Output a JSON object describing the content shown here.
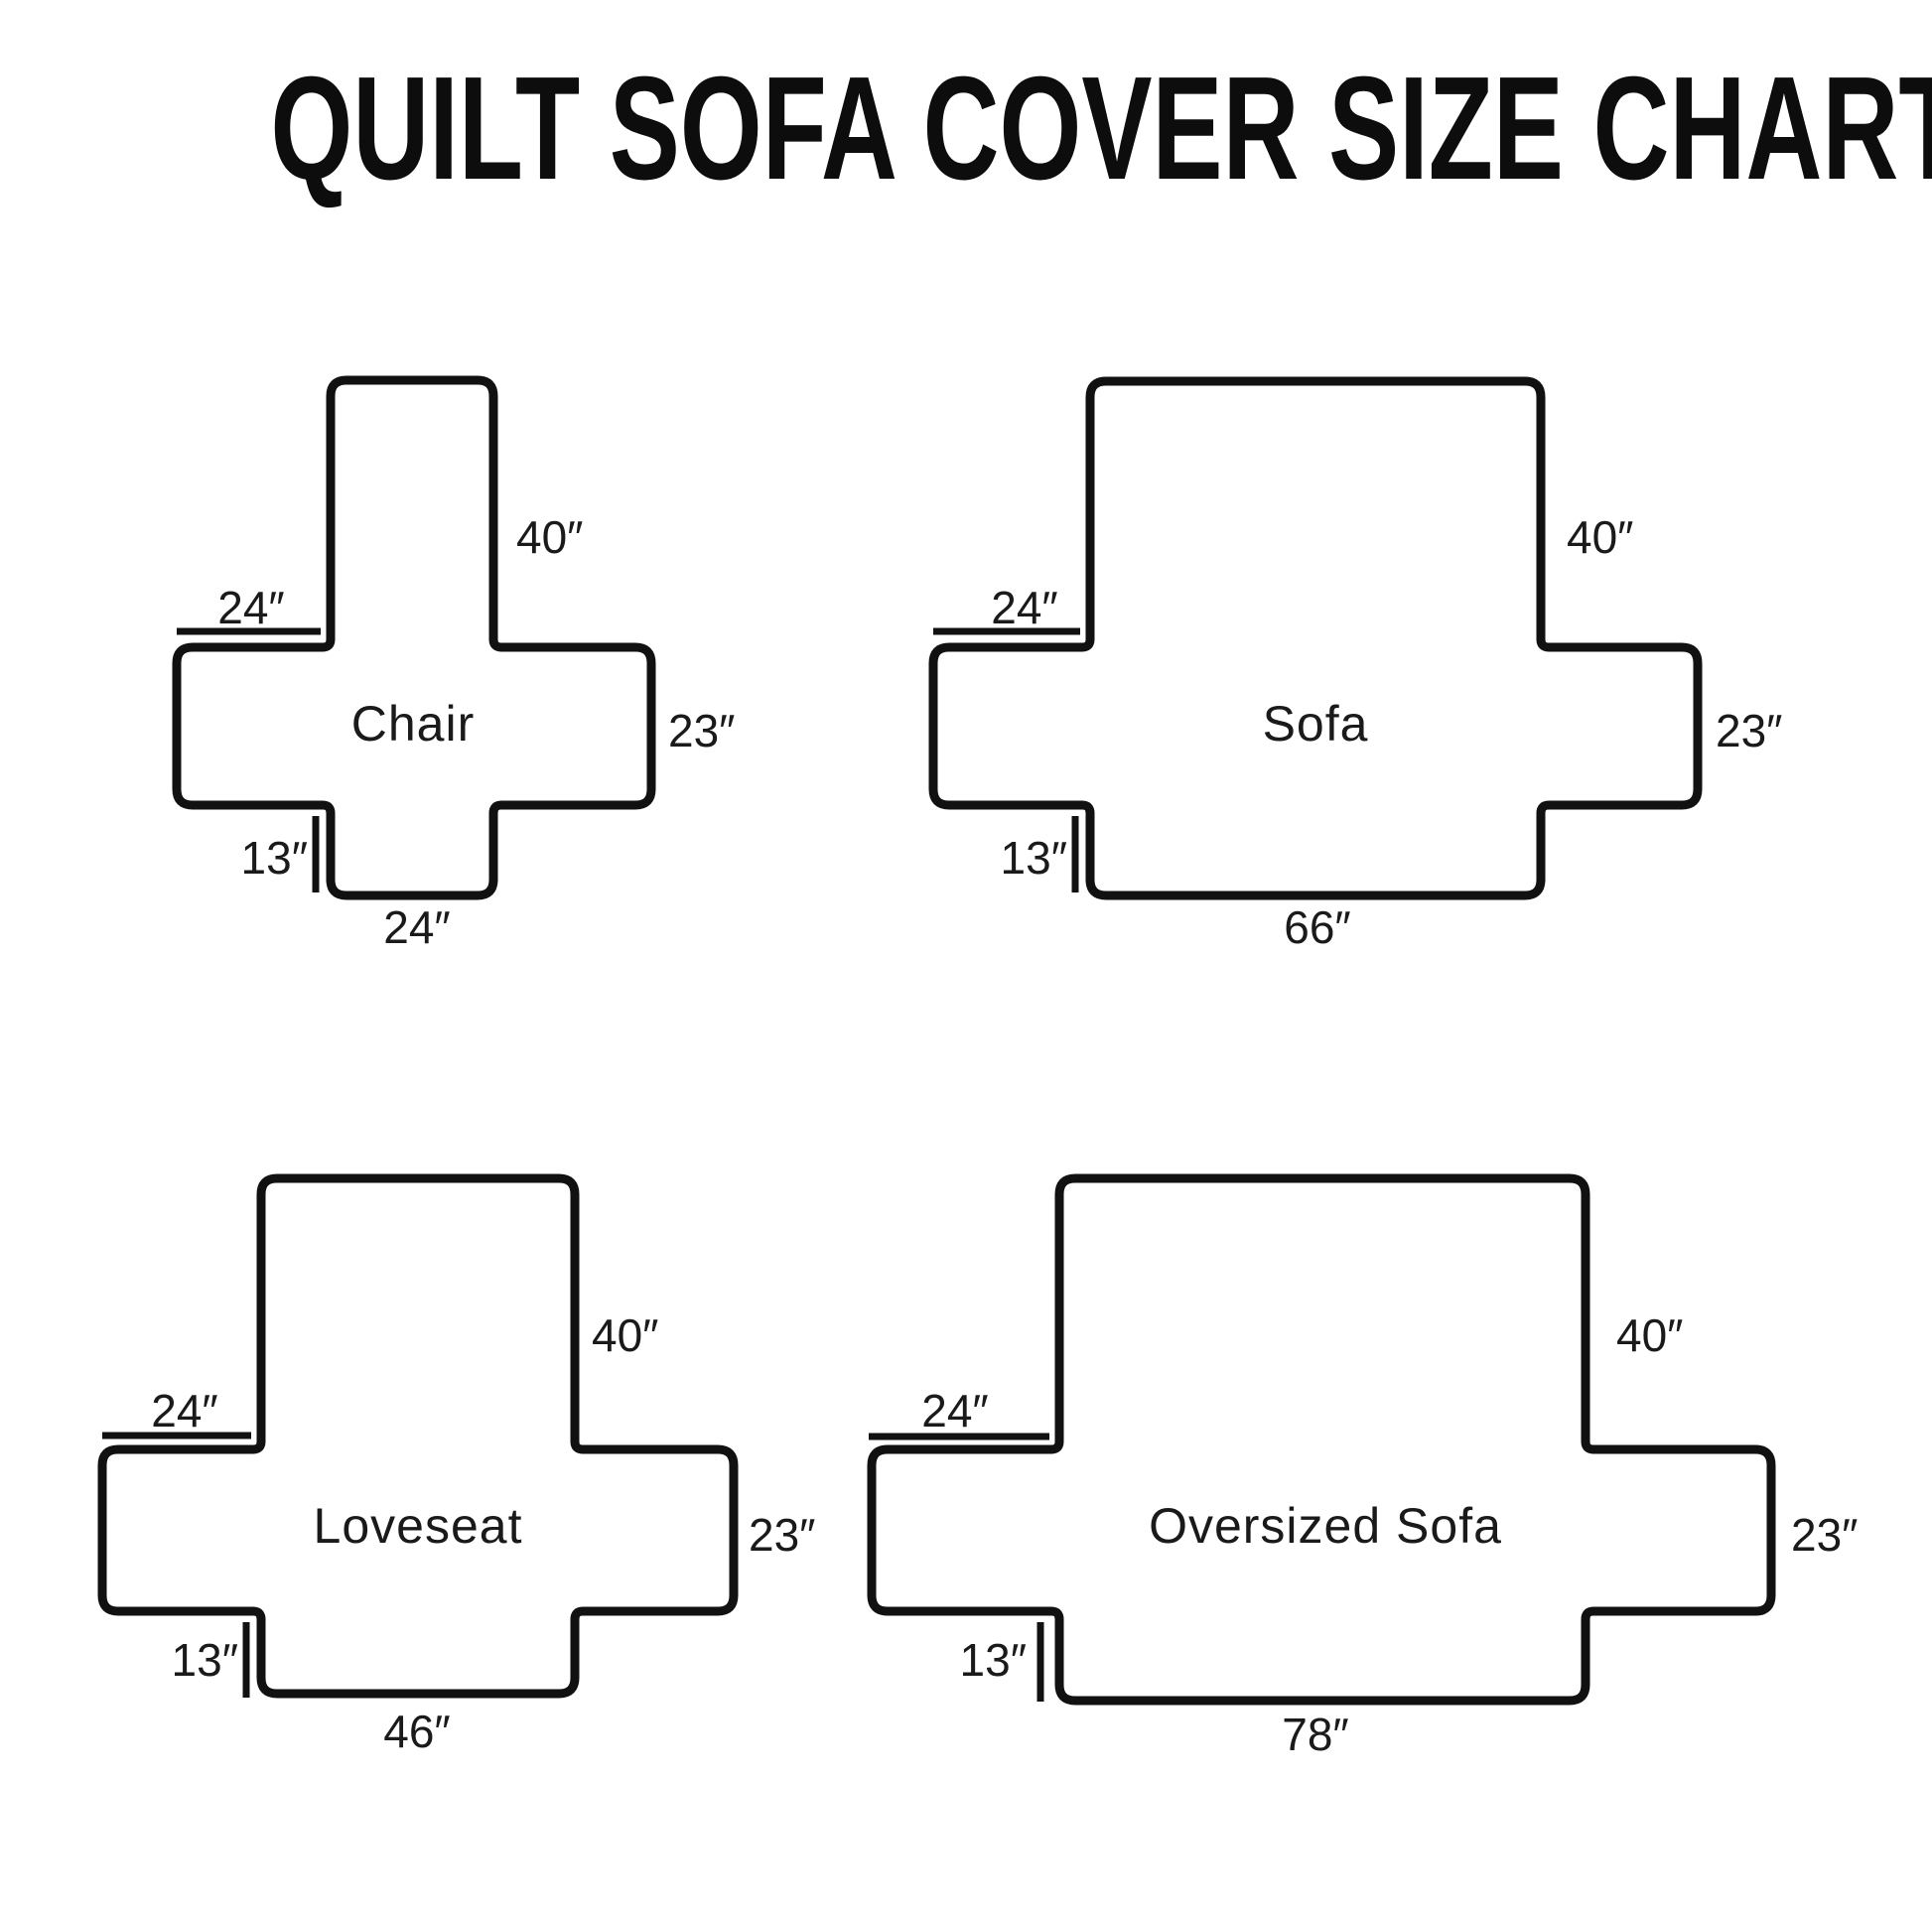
{
  "title": "QUILT SOFA COVER SIZE CHART",
  "colors": {
    "ink": "#111111",
    "background": "#ffffff"
  },
  "diagrams": [
    {
      "name": "Chair",
      "back_height": "40″",
      "arm_width": "24″",
      "side_height": "23″",
      "front_drop": "13″",
      "seat_width": "24″"
    },
    {
      "name": "Sofa",
      "back_height": "40″",
      "arm_width": "24″",
      "side_height": "23″",
      "front_drop": "13″",
      "seat_width": "66″"
    },
    {
      "name": "Loveseat",
      "back_height": "40″",
      "arm_width": "24″",
      "side_height": "23″",
      "front_drop": "13″",
      "seat_width": "46″"
    },
    {
      "name": "Oversized Sofa",
      "back_height": "40″",
      "arm_width": "24″",
      "side_height": "23″",
      "front_drop": "13″",
      "seat_width": "78″"
    }
  ]
}
